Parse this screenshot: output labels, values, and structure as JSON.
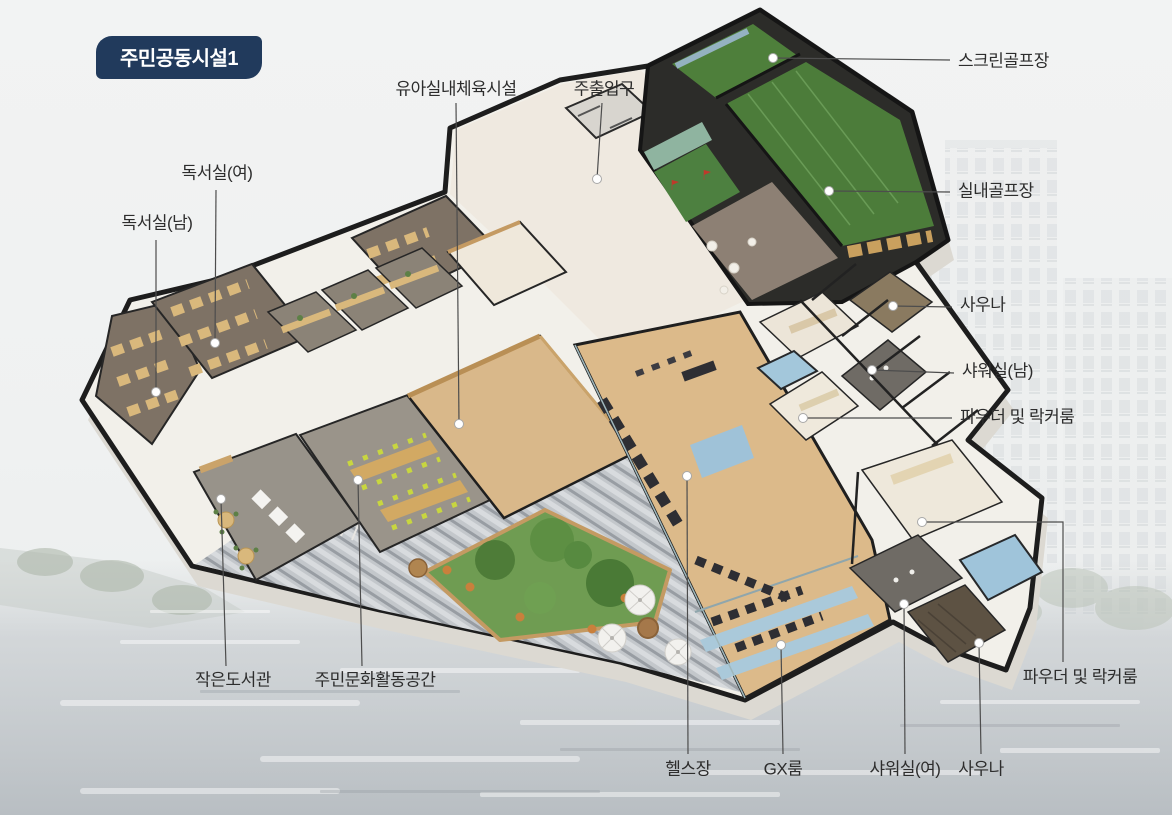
{
  "badge": {
    "label": "주민공동시설1"
  },
  "labels": {
    "nursery_gym": "유아실내체육시설",
    "main_entrance": "주출입구",
    "screen_golf": "스크린골프장",
    "indoor_golf": "실내골프장",
    "sauna_men": "사우나",
    "shower_men": "샤워실(남)",
    "powder_locker_men": "파우더 및 락커룸",
    "reading_room_women": "독서실(여)",
    "reading_room_men": "독서실(남)",
    "small_library": "작은도서관",
    "culture_space": "주민문화활동공간",
    "fitness_center": "헬스장",
    "gx_room": "GX룸",
    "shower_women": "샤워실(여)",
    "sauna_women": "사우나",
    "powder_locker_women": "파우더 및 락커룸"
  },
  "colors": {
    "badge_bg": "#213a5c",
    "badge_text": "#ffffff",
    "label_text": "#2d2d2d",
    "leader_line": "#4d4d4d",
    "wall_dark": "#1d1d1d",
    "golf_green": "#4c7c3a",
    "gym_wood": "#dcba8a",
    "pool_blue": "#9fc4da",
    "garden_green": "#6f9c52",
    "reading_carpet": "#7e7265",
    "deck_gray": "#c3c7cb"
  }
}
